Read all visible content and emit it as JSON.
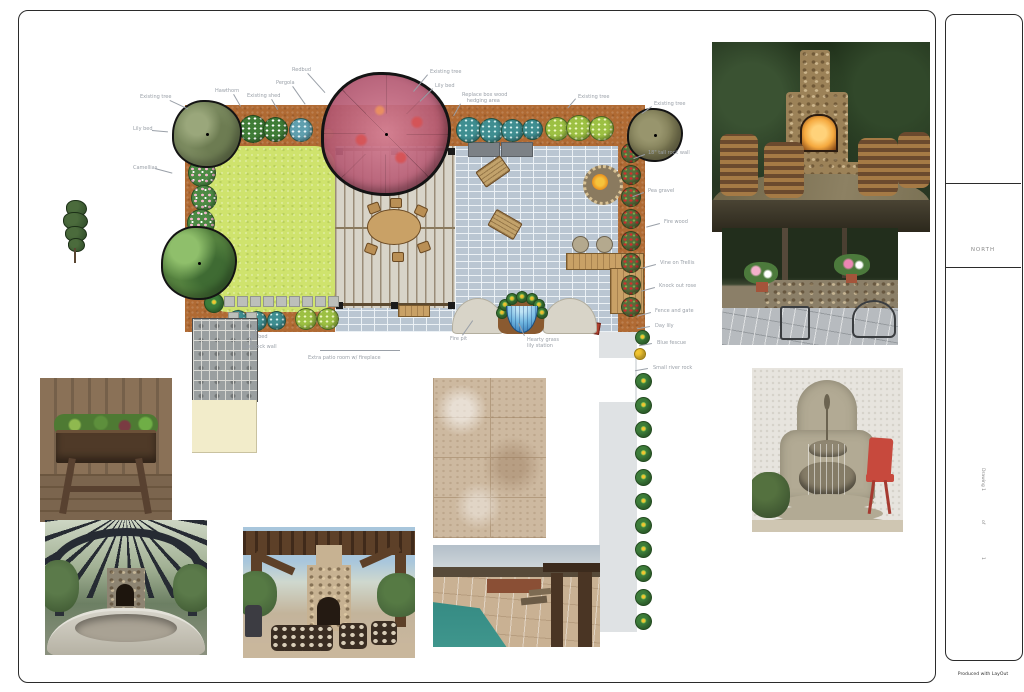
{
  "title_block": {
    "north_label": "NORTH",
    "side_labels": [
      "Drawing 1",
      "of",
      "1"
    ],
    "footer_note": "Produced with LayOut"
  },
  "palette": {
    "mulch_bed": "#b06a33",
    "lawn": "#cfe36d",
    "patio_pavers": "#bac6d2",
    "deck": "#d8d4c8",
    "existing_tree_canopy": "#c4697f",
    "fire_pit": "#e8901f",
    "water_feature": "#2b6fae"
  },
  "plan_labels": [
    {
      "t": "Existing tree",
      "x": 140,
      "y": 95,
      "lx": 170,
      "ly": 100,
      "len": 20,
      "ang": 25
    },
    {
      "t": "Lily bed",
      "x": 133,
      "y": 127,
      "lx": 152,
      "ly": 130,
      "len": 16,
      "ang": 5
    },
    {
      "t": "Camellias",
      "x": 133,
      "y": 166,
      "lx": 155,
      "ly": 168,
      "len": 18,
      "ang": 15
    },
    {
      "t": "Hawthorn",
      "x": 215,
      "y": 89,
      "lx": 234,
      "ly": 94,
      "len": 14,
      "ang": 60
    },
    {
      "t": "Existing shed",
      "x": 247,
      "y": 94,
      "lx": 272,
      "ly": 99,
      "len": 12,
      "ang": 60
    },
    {
      "t": "Redbud",
      "x": 292,
      "y": 68,
      "lx": 308,
      "ly": 73,
      "len": 26,
      "ang": 48
    },
    {
      "t": "Pergola",
      "x": 276,
      "y": 81,
      "lx": 293,
      "ly": 86,
      "len": 22,
      "ang": 55
    },
    {
      "t": "Existing tree",
      "x": 430,
      "y": 70,
      "lx": 428,
      "ly": 75,
      "len": 22,
      "ang": 130
    },
    {
      "t": "Lily bed",
      "x": 435,
      "y": 84,
      "lx": 433,
      "ly": 89,
      "len": 18,
      "ang": 135
    },
    {
      "t": "Replace box wood\n   hedging area",
      "x": 462,
      "y": 93,
      "lx": 461,
      "ly": 104,
      "len": 14,
      "ang": 120
    },
    {
      "t": "Existing tree",
      "x": 578,
      "y": 95,
      "lx": 576,
      "ly": 99,
      "len": 12,
      "ang": 130
    },
    {
      "t": "Existing tree",
      "x": 654,
      "y": 102,
      "lx": 652,
      "ly": 107,
      "len": 12,
      "ang": 145
    },
    {
      "t": "18\" tall rock wall",
      "x": 648,
      "y": 151,
      "lx": 645,
      "ly": 155,
      "len": 12,
      "ang": 160
    },
    {
      "t": "Pea gravel",
      "x": 648,
      "y": 189,
      "lx": 644,
      "ly": 193,
      "len": 12,
      "ang": 160
    },
    {
      "t": "Fire wood",
      "x": 664,
      "y": 220,
      "lx": 660,
      "ly": 224,
      "len": 14,
      "ang": 165
    },
    {
      "t": "Vine on Trellis",
      "x": 660,
      "y": 261,
      "lx": 656,
      "ly": 265,
      "len": 14,
      "ang": 165
    },
    {
      "t": "Knock out rose",
      "x": 659,
      "y": 284,
      "lx": 655,
      "ly": 288,
      "len": 14,
      "ang": 165
    },
    {
      "t": "Fence and gate",
      "x": 655,
      "y": 309,
      "lx": 651,
      "ly": 313,
      "len": 14,
      "ang": 165
    },
    {
      "t": "Day lily",
      "x": 655,
      "y": 324,
      "lx": 650,
      "ly": 327,
      "len": 13,
      "ang": 170
    },
    {
      "t": "Blue fescue",
      "x": 657,
      "y": 341,
      "lx": 652,
      "ly": 344,
      "len": 13,
      "ang": 170
    },
    {
      "t": "Small river rock",
      "x": 653,
      "y": 366,
      "lx": 648,
      "ly": 369,
      "len": 13,
      "ang": 170
    },
    {
      "t": "Lily bed",
      "x": 248,
      "y": 335,
      "lx": 255,
      "ly": 333,
      "len": 8,
      "ang": -90
    },
    {
      "t": "Low rock wall",
      "x": 243,
      "y": 345,
      "lx": 250,
      "ly": 343,
      "len": 10,
      "ang": -80
    },
    {
      "t": "Extra patio room w/ fireplace",
      "x": 308,
      "y": 356,
      "lx": 320,
      "ly": 350,
      "len": 80,
      "ang": 0
    },
    {
      "t": "Fire pit",
      "x": 450,
      "y": 337,
      "lx": 462,
      "ly": 335,
      "len": 18,
      "ang": -55
    },
    {
      "t": "Hearty grass\nlily station",
      "x": 527,
      "y": 338,
      "lx": 524,
      "ly": 336,
      "len": 14,
      "ang": -115
    }
  ]
}
